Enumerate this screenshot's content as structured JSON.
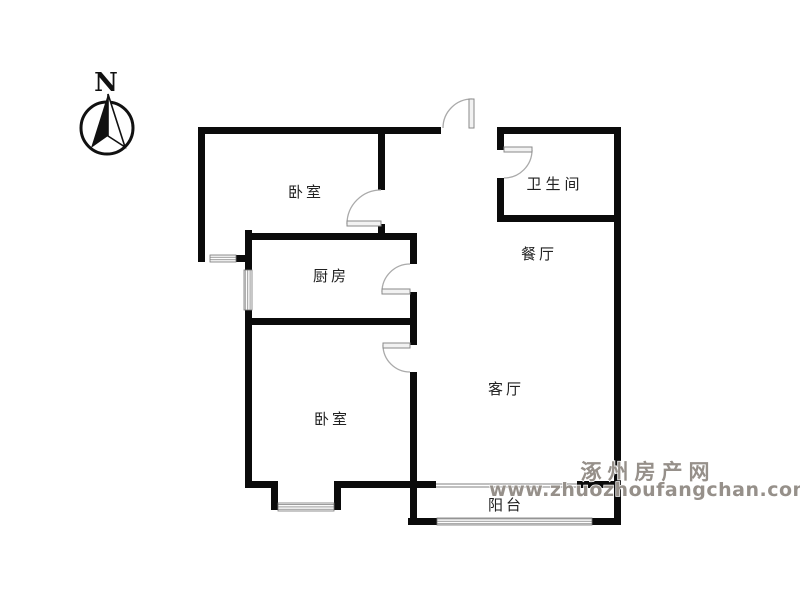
{
  "compass": {
    "label": "N"
  },
  "rooms": [
    {
      "name": "bedroom-top-left",
      "label": "卧室"
    },
    {
      "name": "bathroom",
      "label": "卫生间"
    },
    {
      "name": "dining-room",
      "label": "餐厅"
    },
    {
      "name": "kitchen",
      "label": "厨房"
    },
    {
      "name": "living-room",
      "label": "客厅"
    },
    {
      "name": "bedroom-bottom-left",
      "label": "卧室"
    },
    {
      "name": "balcony",
      "label": "阳台"
    }
  ],
  "watermark": {
    "site_name": "涿州房产网",
    "site_url": "www.zhuozhoufangchan.com"
  },
  "colors": {
    "wall": "#0b0b0b",
    "door_leaf": "#f2f2f2",
    "door_swing": "#aaaaaa",
    "window_stripe": "#999999",
    "label_text": "#222222",
    "watermark_gray": "#96908a",
    "background": "#ffffff"
  }
}
